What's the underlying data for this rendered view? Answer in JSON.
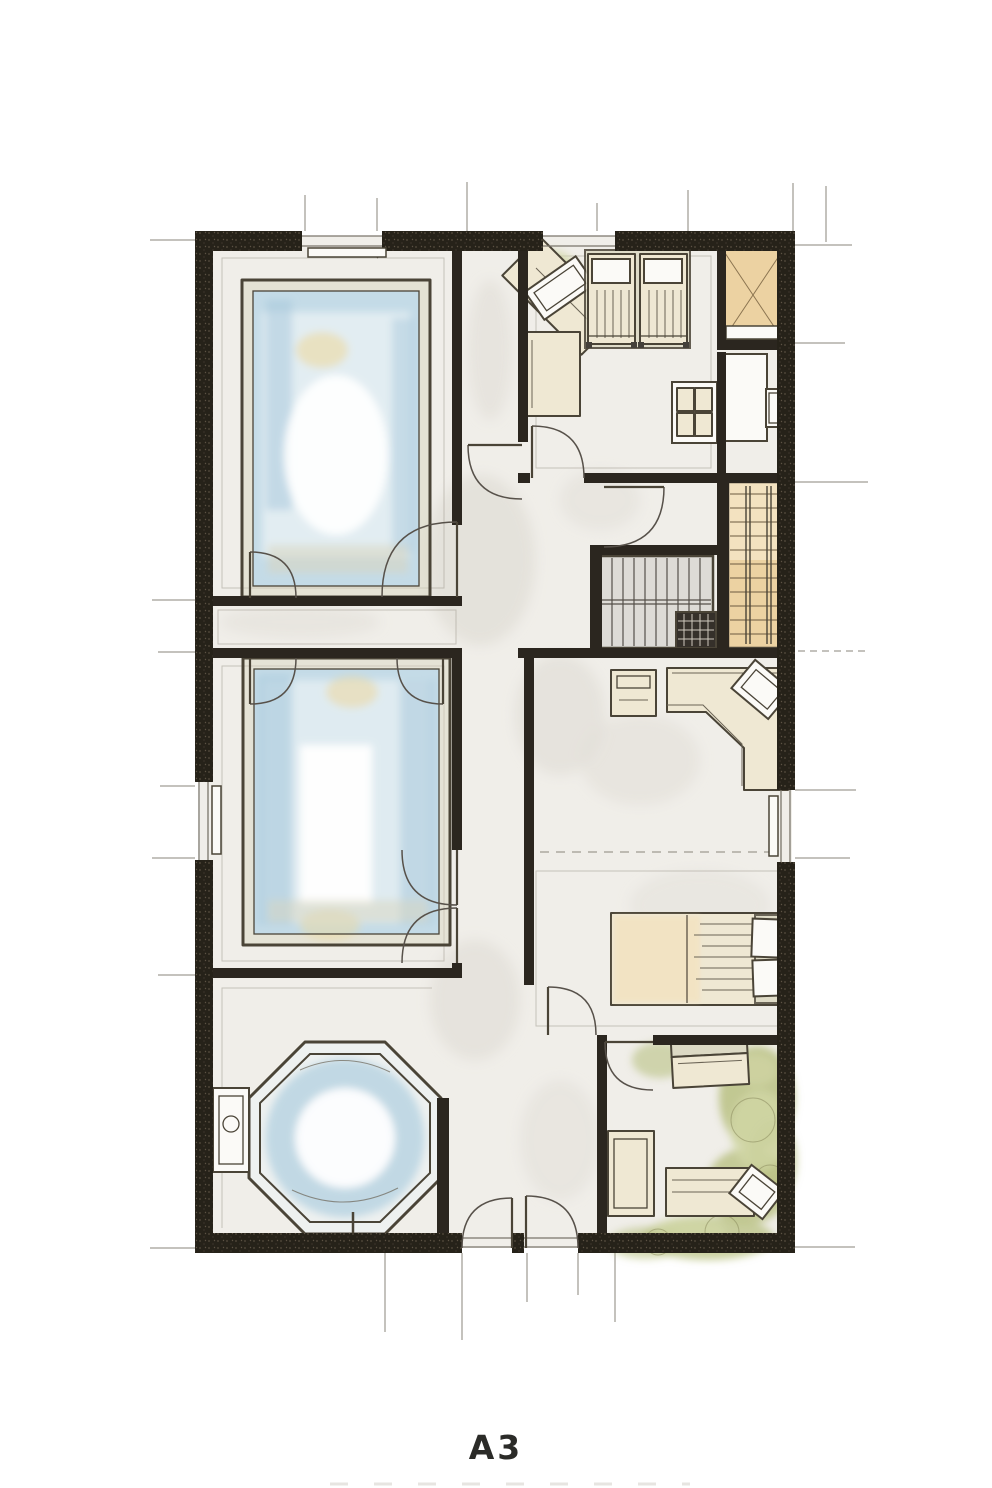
{
  "sheet": {
    "label": "A3"
  },
  "palette": {
    "paper": "#ffffff",
    "wall": "#262219",
    "line": "#4a4437",
    "thin_line": "#8a857b",
    "floor": "#f0eee9",
    "floor_shade": "#e1ded7",
    "water": "#c4dbe7",
    "water_deep": "#a3c6da",
    "water_light": "#e2edf2",
    "sun": "#ecd9a0",
    "deck": "#d8d5bf",
    "furniture": "#efe8d3",
    "furniture_dark": "#dcd9c4",
    "tan": "#ecd2a2",
    "tan_light": "#f3e2c0",
    "olive": "#b9c183",
    "olive_light": "#d3d8a8",
    "stair_gray": "#dddbd6",
    "white": "#fbfaf7"
  }
}
